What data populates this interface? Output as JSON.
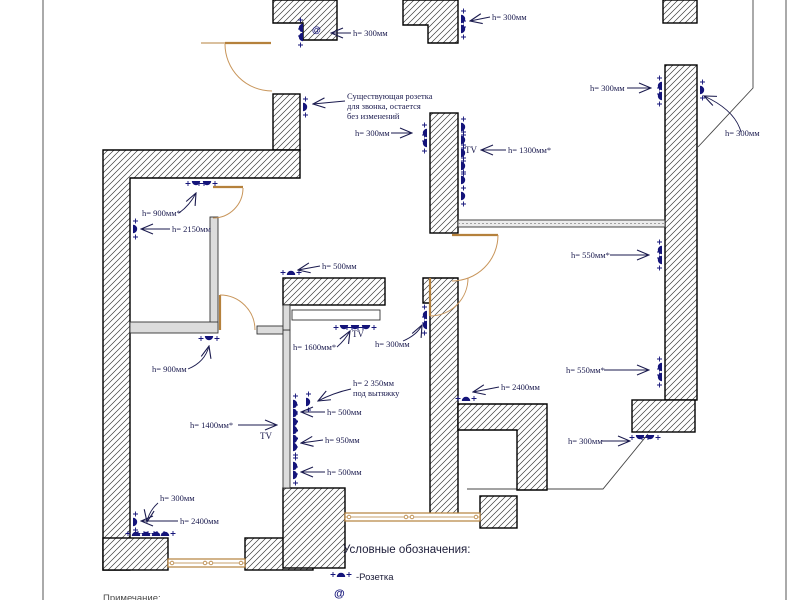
{
  "plan_type": "apartment electrical outlet placement plan",
  "symbols": {
    "at": "@"
  },
  "tv": {
    "label": "TV"
  },
  "note": {
    "line1": "Существующая розетка",
    "line2": "для звонка, остается",
    "line3": "без изменений"
  },
  "annotations": [
    {
      "text": "h= 300мм"
    },
    {
      "text": "h= 300мм"
    },
    {
      "text": "h= 300мм"
    },
    {
      "text": "h= 300мм"
    },
    {
      "text": "h= 300мм"
    },
    {
      "text": "h= 1300мм*"
    },
    {
      "text": "h= 900мм*"
    },
    {
      "text": "h= 2150мм"
    },
    {
      "text": "h= 500мм"
    },
    {
      "text": "h= 550мм*"
    },
    {
      "text": "h= 1600мм*"
    },
    {
      "text": "h= 300мм"
    },
    {
      "text": "h= 900мм"
    },
    {
      "text": "h= 2 350мм",
      "text2": "под вытяжку"
    },
    {
      "text": "h= 500мм"
    },
    {
      "text": "h= 1400мм*"
    },
    {
      "text": "h= 950мм"
    },
    {
      "text": "h= 500мм"
    },
    {
      "text": "h= 550мм*"
    },
    {
      "text": "h= 2400мм"
    },
    {
      "text": "h= 300мм"
    },
    {
      "text": "h= 300мм"
    },
    {
      "text": "h= 2400мм"
    }
  ],
  "legend": {
    "title": "Условные обозначения:",
    "socket_label": "-Розетка"
  },
  "footer": {
    "note_label": "Примечание:"
  },
  "colors": {
    "outlet": "#14147a",
    "annotation": "#1a1a4e",
    "door": "#b5813c",
    "wall_outline": "#000000"
  }
}
